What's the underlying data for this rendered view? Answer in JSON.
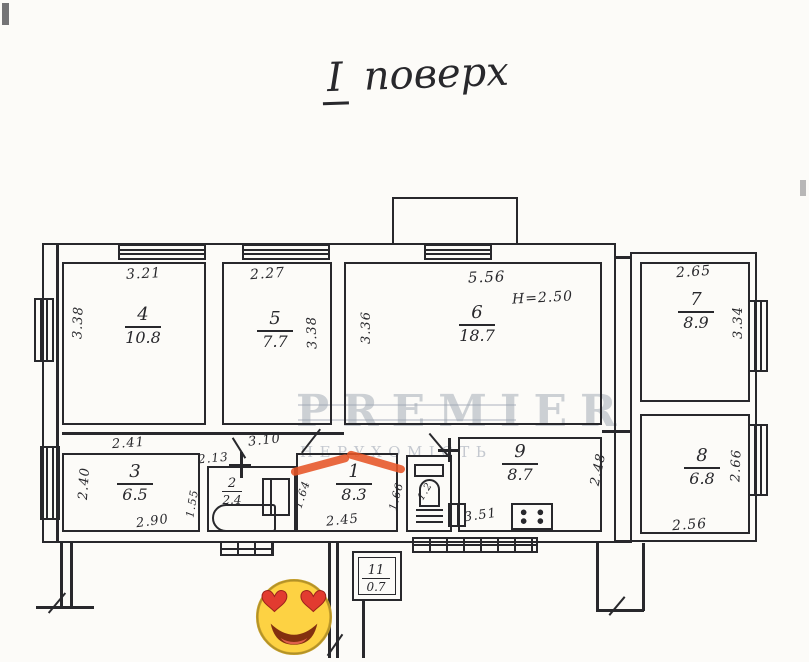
{
  "title": {
    "floor_numeral": "I",
    "floor_word": "поверх"
  },
  "watermark": {
    "brand": "PREMIER",
    "subtitle": "НЕРУХОМІСТЬ"
  },
  "rooms": {
    "r1": {
      "num": "1",
      "area": "8.3"
    },
    "r2": {
      "num": "2",
      "area": "2.4"
    },
    "r3": {
      "num": "3",
      "area": "6.5"
    },
    "r4": {
      "num": "4",
      "area": "10.8"
    },
    "r5": {
      "num": "5",
      "area": "7.7"
    },
    "r6": {
      "num": "6",
      "area": "18.7"
    },
    "r7": {
      "num": "7",
      "area": "8.9"
    },
    "r8": {
      "num": "8",
      "area": "6.8"
    },
    "r9": {
      "num": "9",
      "area": "8.7"
    },
    "r11": {
      "num": "11",
      "area": "0.7"
    }
  },
  "dimensions": {
    "room4_top": "3.21",
    "room4_left": "3.38",
    "room5_top": "2.27",
    "room5_right": "3.38",
    "room6_top": "5.56",
    "ceiling_height": "H=2.50",
    "room6_left": "3.36",
    "room7_top": "2.65",
    "room7_right": "3.34",
    "room8_right": "2.66",
    "room8_bottom": "2.56",
    "room3_top": "2.41",
    "room3_left": "2.40",
    "room3_bottom": "2.90",
    "room3_inner": "1.55",
    "room2_top": "2.13",
    "corridor_top": "3.10",
    "hall_bottom": "2.45",
    "hall_left": "1.64",
    "hall_right": "1.66",
    "kitchen_right": "2.48",
    "kitchen_bottom": "3.51",
    "wc_area": "1.2"
  },
  "colors": {
    "ink": "#28282c",
    "marker_orange": "#e65426",
    "watermark_gray": "#98a0ae",
    "emoji_yellow": "#fdd243",
    "emoji_heart_red": "#e23b30",
    "background": "#fcfbf8"
  },
  "icons": {
    "emoji": "smiling-face-with-heart-eyes"
  }
}
